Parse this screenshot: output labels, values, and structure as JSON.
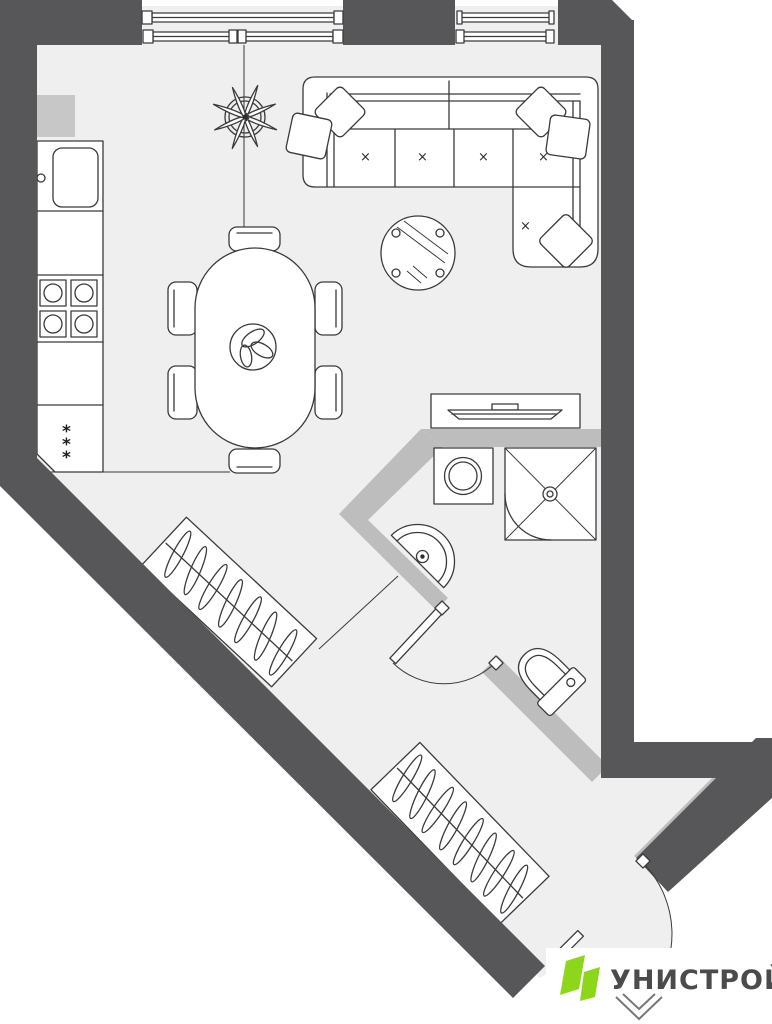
{
  "plan": {
    "title": "apartment-floor-plan",
    "items": [
      "window",
      "window",
      "kitchen-counter",
      "kitchen-sink",
      "stove",
      "freezer",
      "dining-table",
      "chair",
      "chair",
      "chair",
      "chair",
      "chair",
      "chair",
      "table-plant",
      "ceiling-plant",
      "corner-sofa",
      "pillow",
      "pillow",
      "pillow",
      "pillow",
      "pillow",
      "coffee-table",
      "tv-stand",
      "tv",
      "washing-machine",
      "shower",
      "wash-basin",
      "toilet",
      "bathroom-door",
      "wardrobe",
      "wardrobe",
      "entrance-door"
    ]
  },
  "colors": {
    "wall": "#57575A",
    "partition": "#BDBDBD",
    "shaft": "#C7C7C7",
    "floor": "#EFEFEF",
    "outline": "#3A3A3C",
    "white": "#FFFFFF"
  },
  "logo": {
    "text": "УНИСТРОЙ",
    "brand": "#8CD71C",
    "text_color": "#4B4B4E"
  },
  "marks": {
    "cushion": "×",
    "freezer": "*"
  }
}
